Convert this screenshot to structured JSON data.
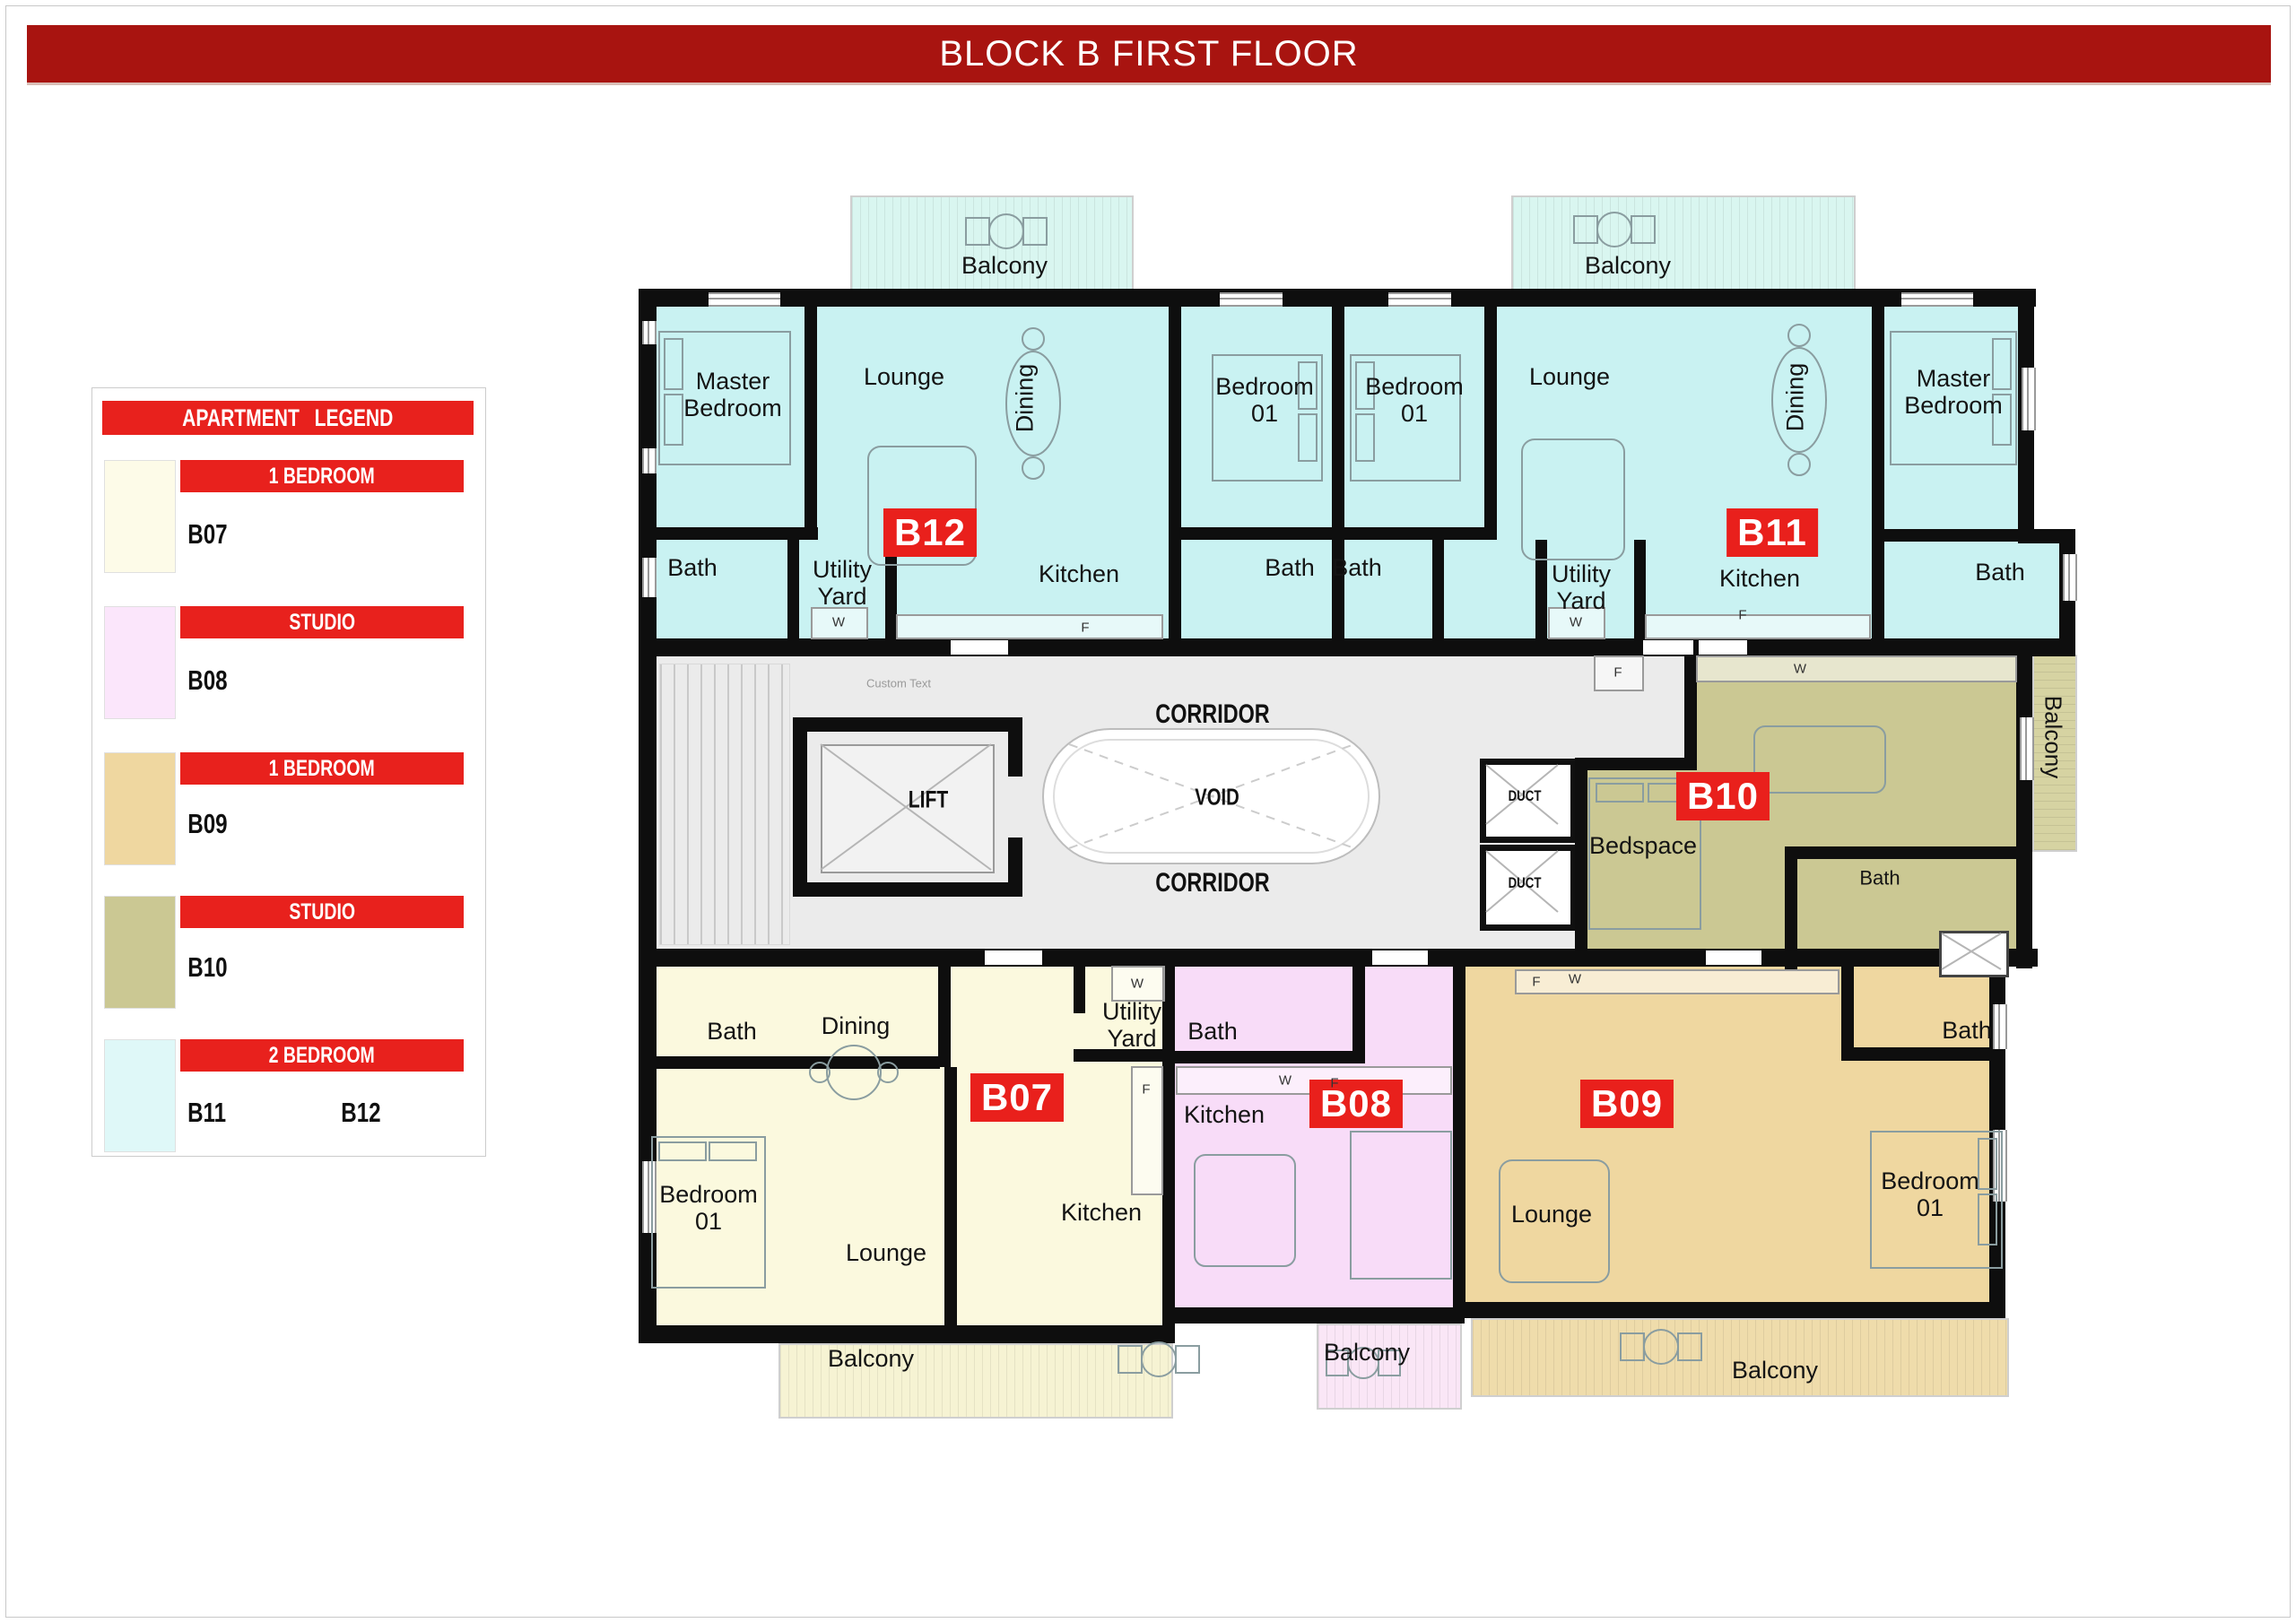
{
  "page": {
    "title": "BLOCK B FIRST FLOOR"
  },
  "colors": {
    "title_bar": "#A81410",
    "legend_red": "#E8211D",
    "badge_red": "#E9201C",
    "wall": "#0E0E0E",
    "corridor": "#EBEBEB",
    "cyan": "#C9F2F2",
    "cyan_balcony": "#D9F6F0",
    "cream": "#FBF9DE",
    "cream_balcony": "#F6F3D3",
    "pink": "#F8DCF8",
    "pink_balcony": "#FAE6F6",
    "tan": "#EFD7A0",
    "tan_balcony": "#EFDCAB",
    "olive": "#CBC893",
    "olive_balcony": "#D6D3A2"
  },
  "legend": {
    "header": "APARTMENT LEGEND",
    "entries": [
      {
        "type": "1 BEDROOM",
        "code": "B07",
        "color": "#FDFBE8"
      },
      {
        "type": "STUDIO",
        "code": "B08",
        "color": "#FBE6FB"
      },
      {
        "type": "1 BEDROOM",
        "code": "B09",
        "color": "#EFD7A0"
      },
      {
        "type": "STUDIO",
        "code": "B10",
        "color": "#CBC893"
      },
      {
        "type": "2 BEDROOM",
        "code": "B11",
        "code2": "B12",
        "color": "#DFF8F8"
      }
    ]
  },
  "units": {
    "b07": {
      "id": "B07",
      "color": "#FBF9DE",
      "bath": "Bath",
      "dining": "Dining",
      "utility": "Utility Yard",
      "bedroom": "Bedroom 01",
      "lounge": "Lounge",
      "kitchen": "Kitchen",
      "balcony": "Balcony"
    },
    "b08": {
      "id": "B08",
      "color": "#F8DCF8",
      "bath": "Bath",
      "kitchen": "Kitchen",
      "balcony": "Balcony"
    },
    "b09": {
      "id": "B09",
      "color": "#EFD7A0",
      "lounge": "Lounge",
      "bedroom": "Bedroom 01",
      "bath": "Bath",
      "balcony": "Balcony"
    },
    "b10": {
      "id": "B10",
      "color": "#CBC893",
      "bedspace": "Bedspace",
      "bath": "Bath",
      "balcony": "Balcony"
    },
    "b11": {
      "id": "B11",
      "color": "#C9F2F2",
      "bedroom": "Bedroom 01",
      "bath": "Bath",
      "utility": "Utility Yard",
      "lounge": "Lounge",
      "dining": "Dining",
      "kitchen": "Kitchen",
      "master": "Master Bedroom",
      "balcony": "Balcony"
    },
    "b12": {
      "id": "B12",
      "color": "#C9F2F2",
      "master": "Master Bedroom",
      "lounge": "Lounge",
      "dining": "Dining",
      "bedroom": "Bedroom 01",
      "bath": "Bath",
      "utility": "Utility Yard",
      "kitchen": "Kitchen",
      "balcony": "Balcony"
    }
  },
  "core": {
    "corridor": "CORRIDOR",
    "void": "VOID",
    "lift": "LIFT",
    "duct": "DUCT",
    "stairs_note": "Custom Text",
    "washer": "W",
    "fridge": "F"
  }
}
